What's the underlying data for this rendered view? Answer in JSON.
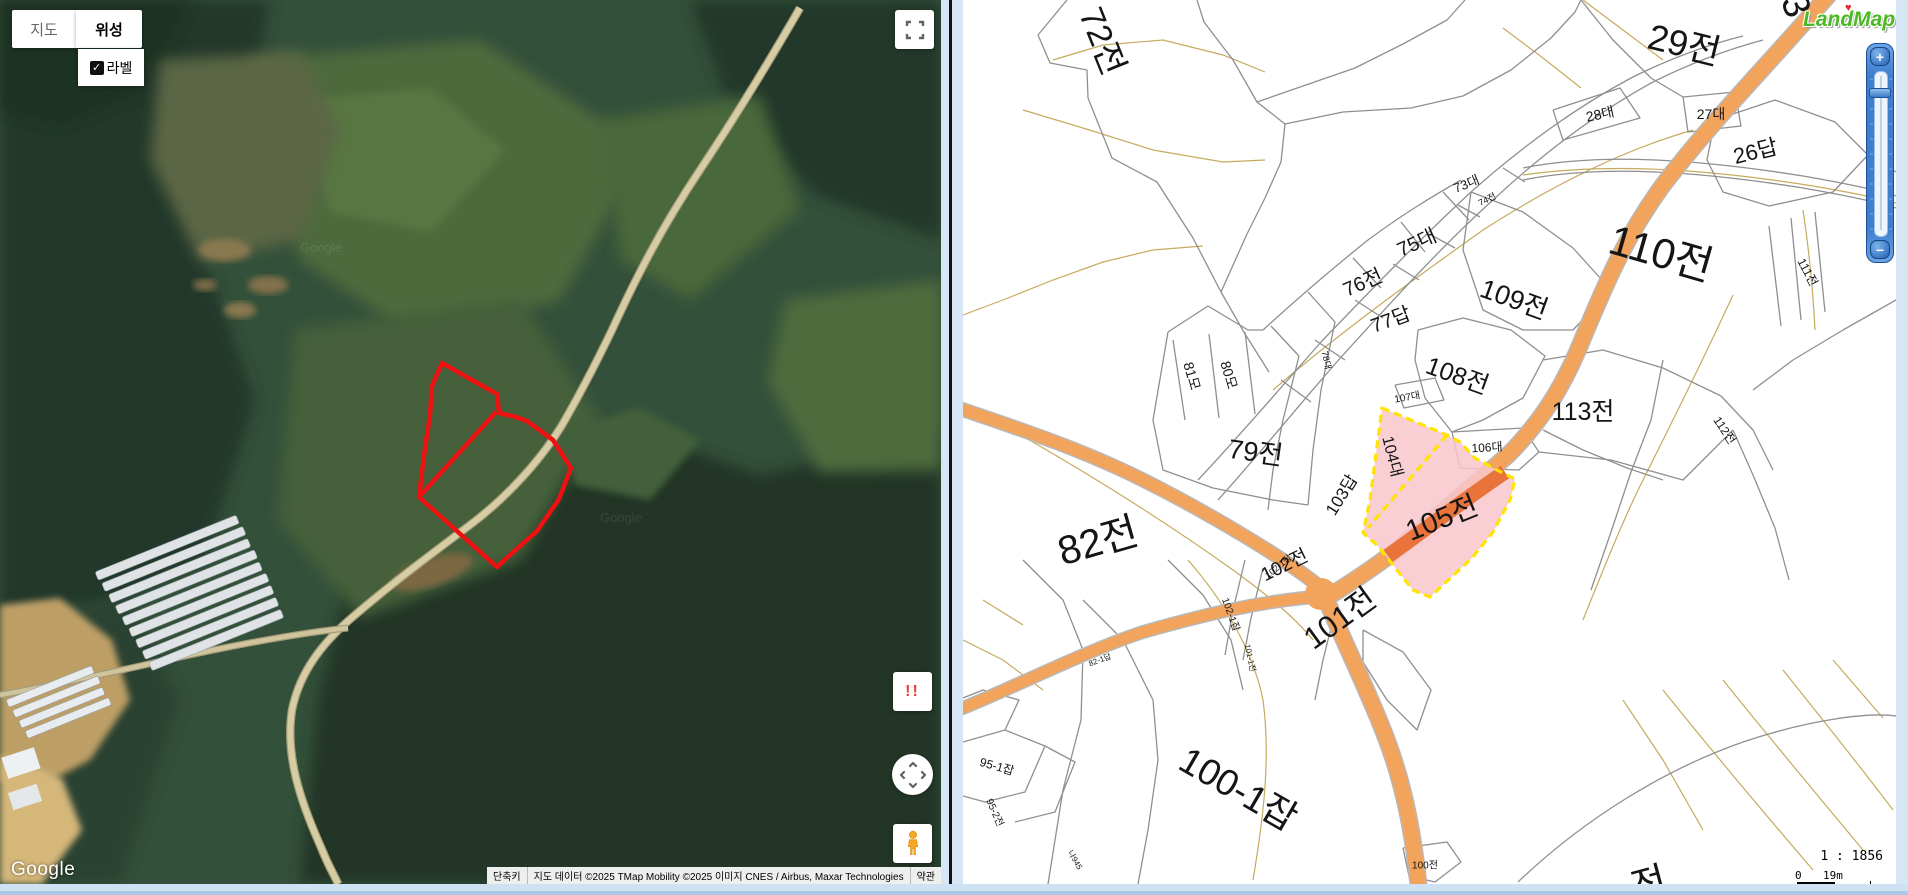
{
  "page": {
    "background": "#d6e6f5"
  },
  "left_map": {
    "type": "satellite",
    "controls": {
      "map_button": "지도",
      "satellite_button": "위성",
      "labels_checkbox_label": "라벨",
      "labels_checked": true,
      "check_glyph": "✓",
      "warning_badge": "!!"
    },
    "google_logo": "Google",
    "watermark": "Google",
    "attribution": {
      "shortcuts": "단축키",
      "map_data": "지도 데이터 ©2025 TMap Mobility ©2025 이미지 CNES / Airbus, Maxar Technologies",
      "terms": "약관"
    },
    "overlay": {
      "parcel_outline_color": "#ee1111"
    }
  },
  "right_map": {
    "logo": "LandMap",
    "logo_heart": "♥",
    "zoom_in_label": "+",
    "zoom_out_label": "−",
    "scale_ratio": "1 : 1856",
    "scale_zero": "0",
    "scale_distance": "19m",
    "highlighted_parcels": [
      "104대",
      "105전"
    ],
    "colors": {
      "road": "#f2a35c",
      "road_dark": "#e8743c",
      "highlight_fill": "#f8c7cd",
      "highlight_border": "#ffe400",
      "boundary": "#8f8f8f",
      "contour": "#c6aa5e",
      "logo_green": "#4cb822"
    },
    "parcel_labels": [
      {
        "text": "72전",
        "x": 142,
        "y": 40,
        "rot": 68,
        "size": 34
      },
      {
        "text": "29전",
        "x": 722,
        "y": 42,
        "rot": 14,
        "size": 36
      },
      {
        "text": "28대",
        "x": 637,
        "y": 114,
        "rot": -12,
        "size": 14
      },
      {
        "text": "27대",
        "x": 748,
        "y": 114,
        "rot": 0,
        "size": 14
      },
      {
        "text": "26답",
        "x": 792,
        "y": 150,
        "rot": -14,
        "size": 22
      },
      {
        "text": "110전",
        "x": 699,
        "y": 250,
        "rot": 16,
        "size": 42
      },
      {
        "text": "111전",
        "x": 845,
        "y": 272,
        "rot": 62,
        "size": 12
      },
      {
        "text": "73대",
        "x": 503,
        "y": 183,
        "rot": -22,
        "size": 13
      },
      {
        "text": "74전",
        "x": 524,
        "y": 199,
        "rot": -26,
        "size": 9
      },
      {
        "text": "75대",
        "x": 453,
        "y": 241,
        "rot": -24,
        "size": 20
      },
      {
        "text": "76전",
        "x": 399,
        "y": 281,
        "rot": -24,
        "size": 20
      },
      {
        "text": "77답",
        "x": 427,
        "y": 318,
        "rot": -20,
        "size": 20
      },
      {
        "text": "78대",
        "x": 364,
        "y": 360,
        "rot": 78,
        "size": 9
      },
      {
        "text": "109전",
        "x": 552,
        "y": 297,
        "rot": 20,
        "size": 27
      },
      {
        "text": "108전",
        "x": 495,
        "y": 374,
        "rot": 20,
        "size": 25
      },
      {
        "text": "107대",
        "x": 444,
        "y": 396,
        "rot": -10,
        "size": 10
      },
      {
        "text": "106대",
        "x": 524,
        "y": 447,
        "rot": -3,
        "size": 12
      },
      {
        "text": "113전",
        "x": 620,
        "y": 410,
        "rot": 0,
        "size": 25
      },
      {
        "text": "112전",
        "x": 762,
        "y": 430,
        "rot": 56,
        "size": 12
      },
      {
        "text": "81모",
        "x": 229,
        "y": 376,
        "rot": 74,
        "size": 14
      },
      {
        "text": "80모",
        "x": 266,
        "y": 375,
        "rot": 74,
        "size": 14
      },
      {
        "text": "79전",
        "x": 293,
        "y": 450,
        "rot": 8,
        "size": 27
      },
      {
        "text": "82전",
        "x": 134,
        "y": 538,
        "rot": -16,
        "size": 40
      },
      {
        "text": "103답",
        "x": 377,
        "y": 494,
        "rot": -58,
        "size": 17
      },
      {
        "text": "104대",
        "x": 431,
        "y": 456,
        "rot": 76,
        "size": 16
      },
      {
        "text": "105전",
        "x": 478,
        "y": 516,
        "rot": -22,
        "size": 29
      },
      {
        "text": "102전",
        "x": 321,
        "y": 564,
        "rot": -26,
        "size": 19
      },
      {
        "text": "102-1잡",
        "x": 269,
        "y": 614,
        "rot": 70,
        "size": 10
      },
      {
        "text": "102-1답",
        "x": 315,
        "y": 566,
        "rot": -40,
        "size": 9
      },
      {
        "text": "101전",
        "x": 375,
        "y": 616,
        "rot": -36,
        "size": 31
      },
      {
        "text": "101-1전",
        "x": 287,
        "y": 658,
        "rot": 78,
        "size": 8
      },
      {
        "text": "82-1답",
        "x": 137,
        "y": 660,
        "rot": -20,
        "size": 8
      },
      {
        "text": "100-1잡",
        "x": 277,
        "y": 786,
        "rot": 30,
        "size": 37
      },
      {
        "text": "95-1잡",
        "x": 34,
        "y": 766,
        "rot": 16,
        "size": 12
      },
      {
        "text": "95-2전",
        "x": 33,
        "y": 812,
        "rot": 66,
        "size": 10
      },
      {
        "text": "100전",
        "x": 462,
        "y": 864,
        "rot": 0,
        "size": 10
      },
      {
        "text": "나945",
        "x": 112,
        "y": 860,
        "rot": 60,
        "size": 8
      },
      {
        "text": "3",
        "x": 832,
        "y": 6,
        "rot": 68,
        "size": 38
      },
      {
        "text": "전",
        "x": 685,
        "y": 880,
        "rot": -15,
        "size": 38
      }
    ]
  }
}
